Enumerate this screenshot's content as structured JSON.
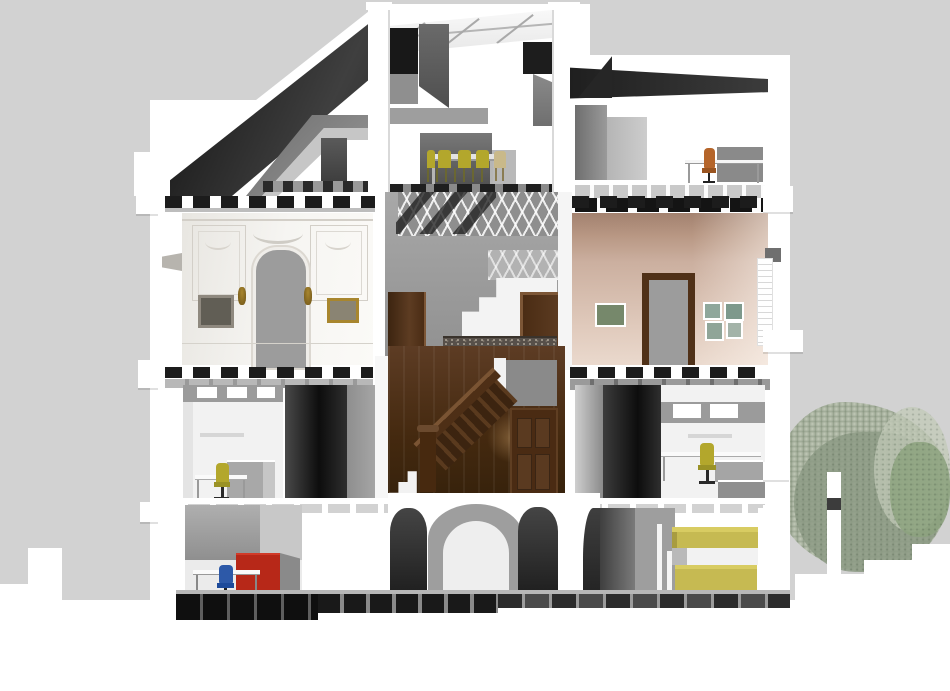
{
  "title": "building-cross-section-rendering",
  "palette": {
    "bg": "#d2d2d2",
    "paper": "#ffffff",
    "roof-black": "#141414",
    "roof-dark": "#2e2e2e",
    "gray-dark": "#4a4a4a",
    "gray-mid": "#8e8e8e",
    "gray-light": "#c9c9c9",
    "stucco": "#f4f3f0",
    "stucco-line": "#d3cfc8",
    "beige": "#cbaf9f",
    "beige-dark": "#a2816f",
    "wood": "#4a2b13",
    "wood-light": "#7a5433",
    "door-gray": "#9c9c9c",
    "chair-yellow": "#b3a72c",
    "chair-orange": "#b5652a",
    "chair-blue": "#2d59a8",
    "cabinet-red": "#b72818",
    "shelf-yellow": "#c6ba52",
    "shelf-yellow-light": "#d8cc62",
    "foliage": "#a3ad9a",
    "foliage-dark": "#8c9a84",
    "foliage-light": "#c2cab8",
    "gold": "#a8862e",
    "railing": "#57504a"
  },
  "scene": {
    "type": "architectural-section",
    "floors": [
      {
        "name": "attic",
        "rooms": [
          "left-attic-room",
          "dining-room",
          "attic-office"
        ]
      },
      {
        "name": "second-floor",
        "rooms": [
          "stucco-salon",
          "stair-landing",
          "beige-salon"
        ]
      },
      {
        "name": "first-floor",
        "rooms": [
          "office-left",
          "wood-stair-hall",
          "office-right"
        ]
      },
      {
        "name": "basement",
        "rooms": [
          "archive-room",
          "vaulted-cellar",
          "storage-room"
        ]
      }
    ],
    "furniture": [
      {
        "item": "dining-chairs",
        "color_key": "chair-yellow",
        "room": "dining-room"
      },
      {
        "item": "office-chair",
        "color_key": "chair-orange",
        "room": "attic-office"
      },
      {
        "item": "office-chair",
        "color_key": "chair-yellow",
        "room": "office-left"
      },
      {
        "item": "office-chair",
        "color_key": "chair-yellow",
        "room": "office-right"
      },
      {
        "item": "office-chair",
        "color_key": "chair-blue",
        "room": "archive-room"
      },
      {
        "item": "cabinet",
        "color_key": "cabinet-red",
        "room": "archive-room"
      },
      {
        "item": "shelving",
        "color_key": "shelf-yellow",
        "room": "storage-room"
      },
      {
        "item": "wall-sconces",
        "color_key": "gold",
        "room": "stucco-salon"
      }
    ],
    "environment": {
      "trees": "foliage-right",
      "ground": "white"
    }
  }
}
